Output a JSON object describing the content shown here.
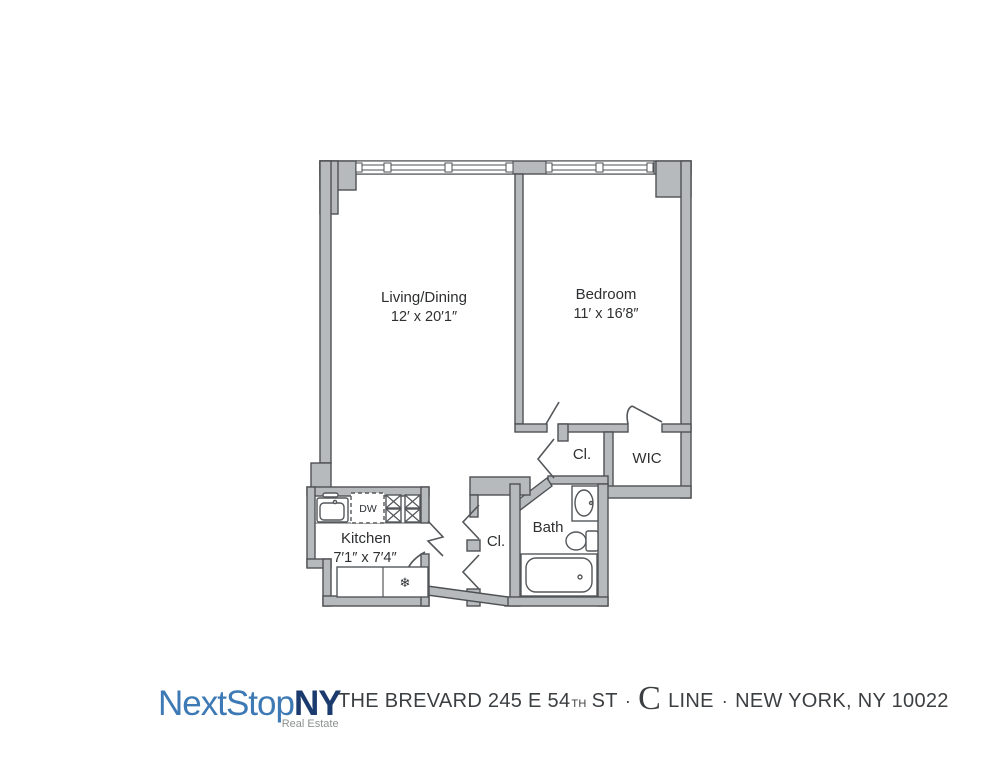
{
  "floorplan": {
    "living": {
      "label": "Living/Dining",
      "dims": "12′ x 20′1″"
    },
    "bedroom": {
      "label": "Bedroom",
      "dims": "11′ x 16′8″"
    },
    "kitchen": {
      "label": "Kitchen",
      "dims": "7′1″ x 7′4″"
    },
    "bath": {
      "label": "Bath"
    },
    "hall_closet": {
      "label": "Cl."
    },
    "bedroom_closet": {
      "label": "Cl."
    },
    "wic": {
      "label": "WIC"
    },
    "appliances": {
      "dishwasher": "DW",
      "refrigerator_icon": "❄"
    },
    "colors": {
      "wall_fill": "#b7babc",
      "wall_stroke": "#4e5154",
      "fixture_stroke": "#54575a",
      "label_color": "#2d2f31"
    }
  },
  "footer": {
    "logo": {
      "part1": "NextStop",
      "part2": "NY",
      "tagline": "Real Estate",
      "color_part1": "#3d79b4",
      "color_part2": "#1b3a6e",
      "color_tagline": "#8e9192"
    },
    "address": {
      "part1": "THE BREVARD 245 E 54",
      "sup": "TH",
      "part2": "ST",
      "dot1": "·",
      "line_letter": "C",
      "line_word": "LINE",
      "dot2": "·",
      "part3": "NEW YORK, NY 10022",
      "color": "#3c3f42"
    }
  }
}
